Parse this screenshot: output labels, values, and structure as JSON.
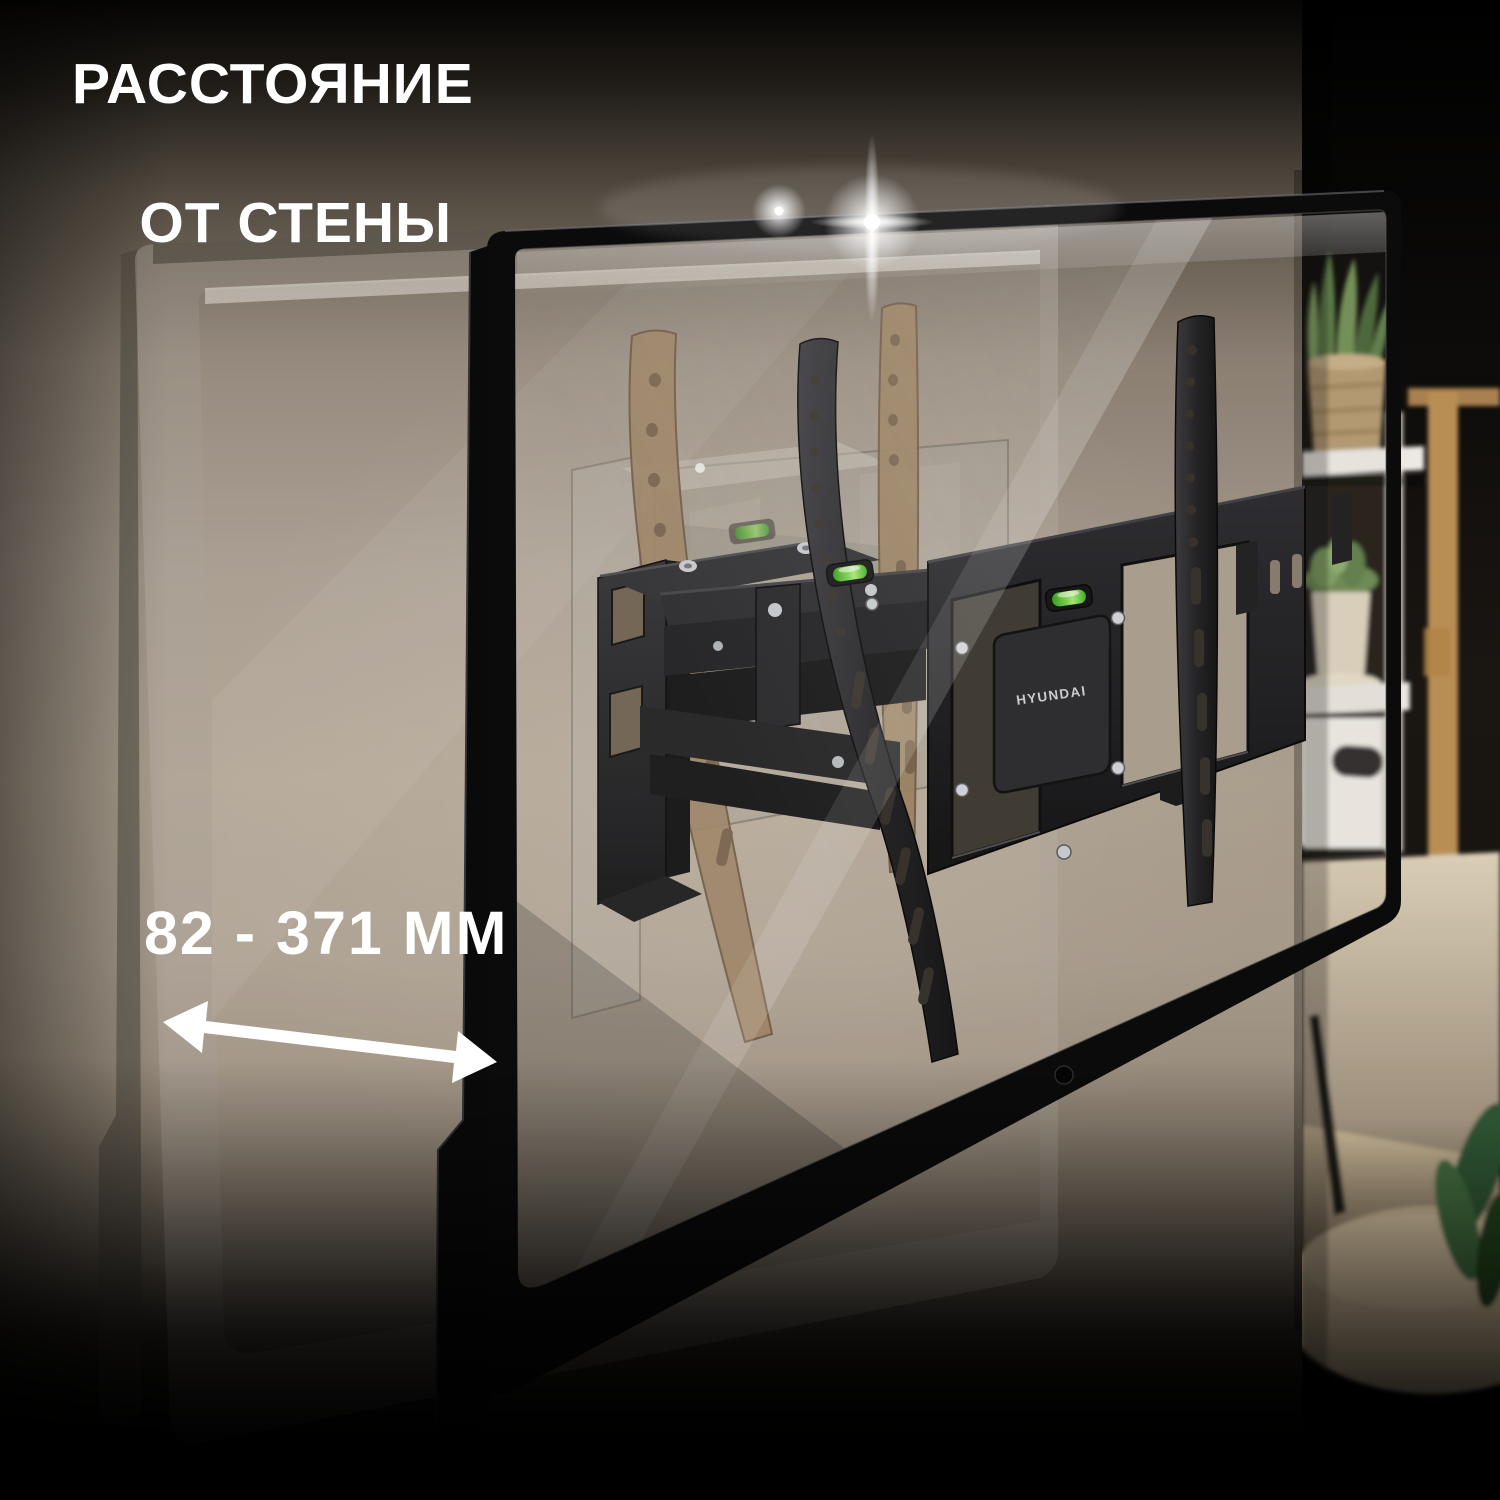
{
  "annotation": {
    "title_line1": "РАССТОЯНИЕ",
    "title_line2": "ОТ СТЕНЫ",
    "distance_label": "82 - 371 ММ"
  },
  "product": {
    "brand": "HYUNDAI"
  },
  "colors": {
    "annotation_white": "#ffffff",
    "wall_beige": "#a79c8d",
    "mount_black": "#1b1b1e",
    "ghost_rail_tan": "#9d8465",
    "bubble_level_green": "#7fd84f",
    "background_dark": "#0a0806"
  }
}
